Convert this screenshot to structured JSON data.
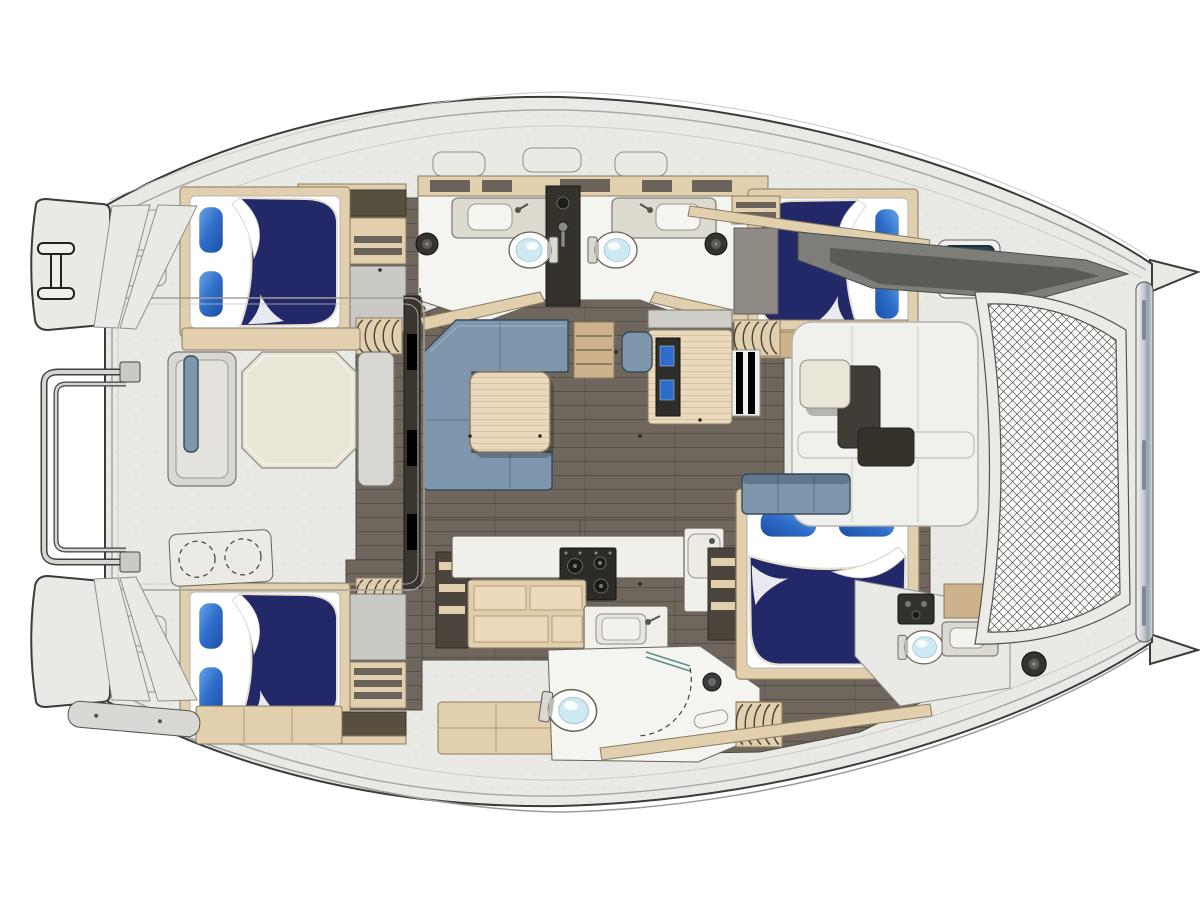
{
  "meta": {
    "title": "Catamaran yacht interior deck plan, top view, bow to the right",
    "orientation": "bow-right"
  },
  "colors": {
    "deck": "#e9e9e6",
    "deck-edge": "#3b3b39",
    "deck-line": "#a8a8a4",
    "deck-line-soft": "#c9c9c5",
    "interior-floor": "#6f675d",
    "white-room": "#f4f4f1",
    "wood-light": "#e2cfae",
    "wood-mid": "#cdb28b",
    "wood-dark": "#57503f",
    "wood-edge": "#8a7a5f",
    "bed-navy": "#222868",
    "sofa-blue": "#7e97ad",
    "sofa-edge": "#394a5a",
    "cream": "#e9e6d7",
    "counter-white": "#f1efe9",
    "counter-edge": "#67635c",
    "stove-dark": "#2d2b28",
    "toilet-bowl": "#cfe9f2",
    "hatch-teal": "#28434f",
    "glass-teal": "#5d8d8f",
    "mesh-line": "#55534e",
    "gray-bench": "#d8d7d3",
    "dark-fitting": "#33312d"
  },
  "areas": [
    {
      "id": "aft-cockpit",
      "label": "Aft cockpit with dining table and benches"
    },
    {
      "id": "salon",
      "label": "Salon with L-shaped settee and coffee table"
    },
    {
      "id": "galley",
      "label": "Galley with stove, sink and drawers"
    },
    {
      "id": "port-aft-cabin",
      "label": "Port aft double cabin"
    },
    {
      "id": "port-heads",
      "label": "Port twin head compartments with toilets and basins"
    },
    {
      "id": "port-fwd-cabin",
      "label": "Port forward double cabin"
    },
    {
      "id": "stb-aft-cabin",
      "label": "Starboard aft double cabin"
    },
    {
      "id": "stb-shower-head",
      "label": "Starboard head with shower compartment"
    },
    {
      "id": "owner-cabin",
      "label": "Starboard forward double cabin"
    },
    {
      "id": "stb-fwd-head",
      "label": "Starboard forward head with toilet and basin"
    },
    {
      "id": "fwd-cockpit",
      "label": "Forward cockpit lounge"
    },
    {
      "id": "trampoline",
      "label": "Bow trampoline net"
    },
    {
      "id": "transoms",
      "label": "Twin transom swim steps"
    },
    {
      "id": "davits",
      "label": "Stern davit rail"
    }
  ],
  "furniture": {
    "double_berths": 4,
    "pillows": 8,
    "toilets": 4,
    "basins": 4,
    "showers": 1,
    "galley_burners": 4,
    "dining_tables": 2,
    "settees": 2,
    "companionway_stairs": 4,
    "deck_hatches": 3,
    "trampolines": 1,
    "transom_step_sets": 2,
    "davit_rails": 1
  }
}
